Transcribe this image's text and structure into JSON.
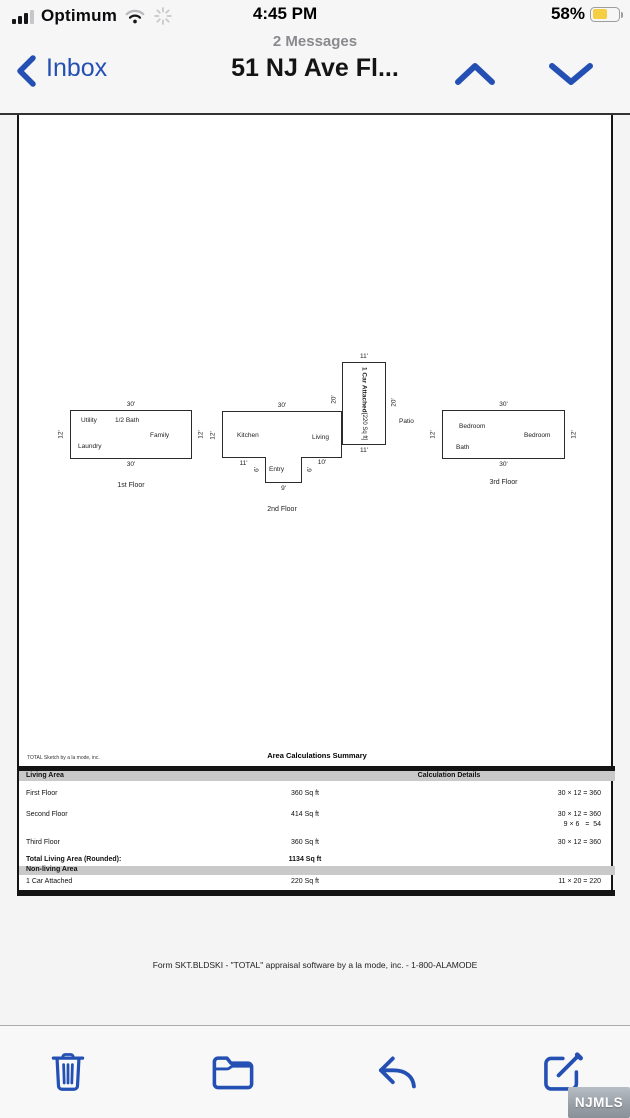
{
  "colors": {
    "accent": "#2450b4",
    "battery_fill": "#f6ce43",
    "table_band": "#c9c9c9"
  },
  "status_bar": {
    "carrier": "Optimum",
    "time": "4:45 PM",
    "battery_percent": "58%",
    "icons": [
      "cellular-signal-icon",
      "wifi-icon",
      "activity-spinner-icon",
      "battery-icon"
    ]
  },
  "nav_bar": {
    "back_label": "Inbox",
    "messages_count": "2 Messages",
    "title": "51 NJ Ave Fl...",
    "icons": [
      "back-chevron-icon",
      "previous-message-chevron-up-icon",
      "next-message-chevron-down-icon"
    ]
  },
  "sketch": {
    "floor1": {
      "name": "1st Floor",
      "dim_top": "30'",
      "dim_bottom": "30'",
      "dim_left": "12'",
      "dim_right": "12'",
      "rooms": {
        "utility": "Utility",
        "half_bath": "1/2 Bath",
        "family": "Family",
        "laundry": "Laundry"
      }
    },
    "floor2": {
      "name": "2nd Floor",
      "dim_top": "30'",
      "dim_left": "12'",
      "dim_bottom_left": "11'",
      "dim_bottom_right": "10'",
      "dim_notch_left": "6'",
      "dim_notch_right": "6'",
      "dim_notch_bottom": "9'",
      "rooms": {
        "kitchen": "Kitchen",
        "living": "Living",
        "entry": "Entry"
      }
    },
    "floor3": {
      "name": "3rd Floor",
      "dim_top": "30'",
      "dim_bottom": "30'",
      "dim_left": "12'",
      "dim_right": "12'",
      "rooms": {
        "bedroom1": "Bedroom",
        "bedroom2": "Bedroom",
        "bath": "Bath"
      }
    },
    "garage": {
      "line1": "1 Car Attached",
      "line2": "[220 Sq ft]",
      "dim_top": "11'",
      "dim_bottom": "11'",
      "dim_left": "20'",
      "dim_right": "20'"
    },
    "patio_label": "Patio"
  },
  "table": {
    "provider": "TOTAL Sketch by a la mode, inc.",
    "title": "Area Calculations Summary",
    "living_header": "Living Area",
    "calc_header": "Calculation Details",
    "rows": [
      {
        "label": "First Floor",
        "area": "360 Sq ft",
        "calc1": "30 × 12 = 360",
        "calc2": ""
      },
      {
        "label": "Second Floor",
        "area": "414 Sq ft",
        "calc1": "30 × 12 = 360",
        "calc2": "9 × 6   =  54"
      },
      {
        "label": "Third Floor",
        "area": "360 Sq ft",
        "calc1": "30 × 12 = 360",
        "calc2": ""
      }
    ],
    "total_label": "Total Living Area (Rounded):",
    "total_value": "1134 Sq ft",
    "nonliving_header": "Non-living Area",
    "nonliving_row": {
      "label": "1 Car Attached",
      "area": "220 Sq ft",
      "calc1": "11 × 20 = 220"
    }
  },
  "footer": {
    "form_line": "Form SKT.BLDSKI - \"TOTAL\" appraisal software by a la mode, inc. - 1-800-ALAMODE"
  },
  "toolbar": {
    "icons": [
      "trash-icon",
      "folder-icon",
      "reply-icon",
      "compose-icon"
    ]
  },
  "watermark": "NJMLS"
}
